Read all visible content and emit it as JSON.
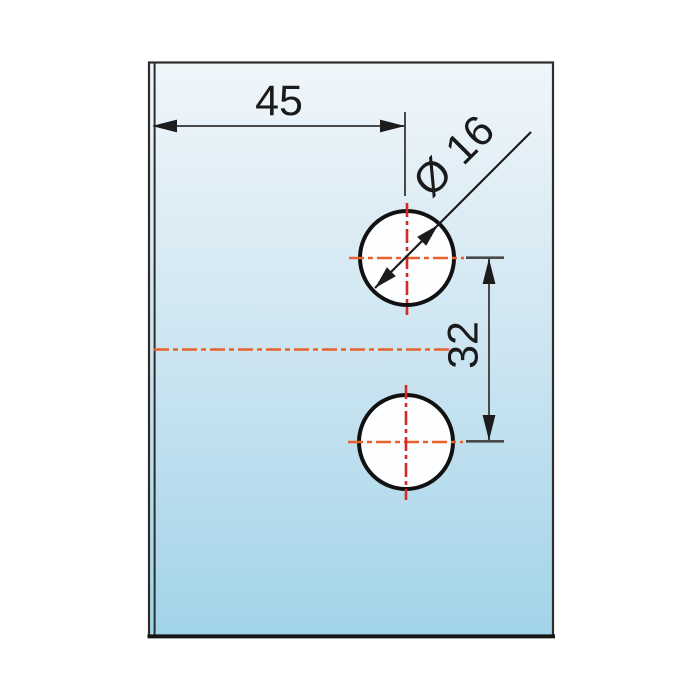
{
  "drawing": {
    "name": "panel-drilling-template",
    "description": "Technical drawing of a glass panel with two drilled holes",
    "labels": {
      "horizontal_dim": "45",
      "vertical_dim": "32",
      "diameter_dim": "Ø 16"
    },
    "values": {
      "horizontal_offset": 45,
      "hole_spacing": 32,
      "hole_diameter": 16
    },
    "colors": {
      "page_background": "#ffffff",
      "panel_top": "#f0f6fa",
      "panel_mid": "#cde5f1",
      "panel_bottom": "#a1d4e9",
      "panel_edge": "#2d2d2d",
      "panel_bottom_edge": "#161616",
      "hole_fill": "#fdfeff",
      "hole_stroke": "#111111",
      "centerline_horizontal": "#e8602c",
      "centerline_vertical": "#d42a24",
      "dim_line": "#4a4a4a",
      "arrow": "#1c1c1c",
      "text": "#1a1a1a"
    }
  }
}
